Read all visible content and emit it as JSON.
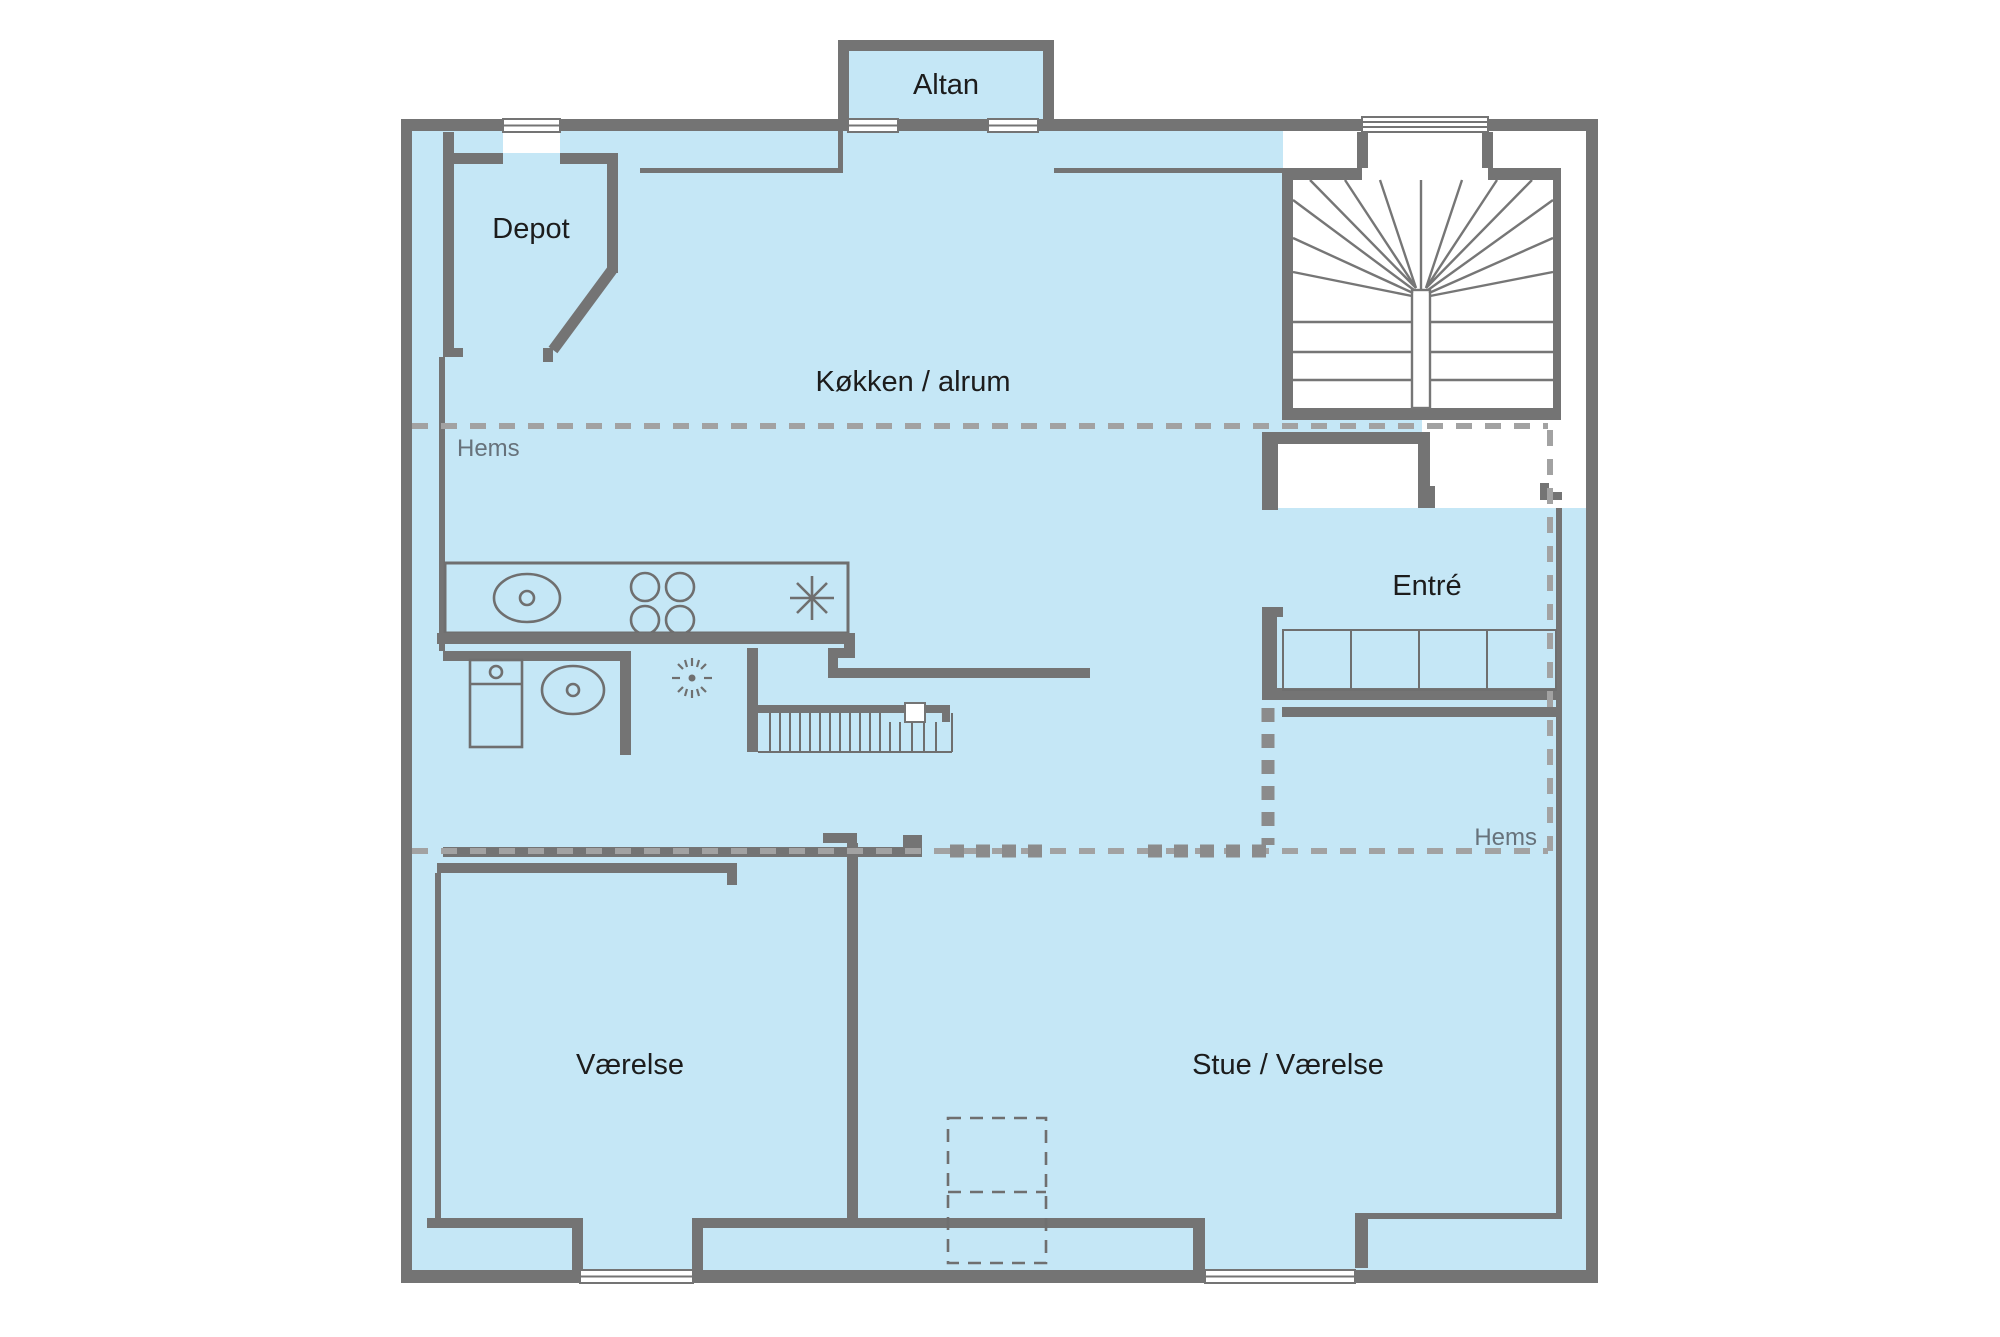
{
  "floorplan": {
    "labels": {
      "altan": "Altan",
      "depot": "Depot",
      "kitchen": "Køkken / alrum",
      "hems_upper": "Hems",
      "entre": "Entré",
      "hems_lower": "Hems",
      "room1": "Værelse",
      "room2": "Stue / Værelse"
    },
    "colors": {
      "floor_fill": "#c5e7f6",
      "wall": "#747474",
      "fixture_line": "#6f6f6f",
      "hems_dash": "#a2a2a2",
      "opening_dash": "#8b8b8b",
      "room_label": "#1c1c1c",
      "hems_label": "#67727b",
      "background": "#ffffff"
    },
    "icons": {
      "kitchen_sink": "sink-icon",
      "stove": "stove-4-burner-icon",
      "lamp": "ceiling-lamp-icon",
      "toilet": "toilet-icon",
      "washbasin": "washbasin-icon",
      "shower": "shower-drain-icon",
      "wardrobe": "wardrobe-icon",
      "winder_stairs": "winder-stairs-icon",
      "straight_stairs": "straight-stairs-icon",
      "chimney": "chimney-dashed-icon",
      "window": "window-icon"
    }
  }
}
